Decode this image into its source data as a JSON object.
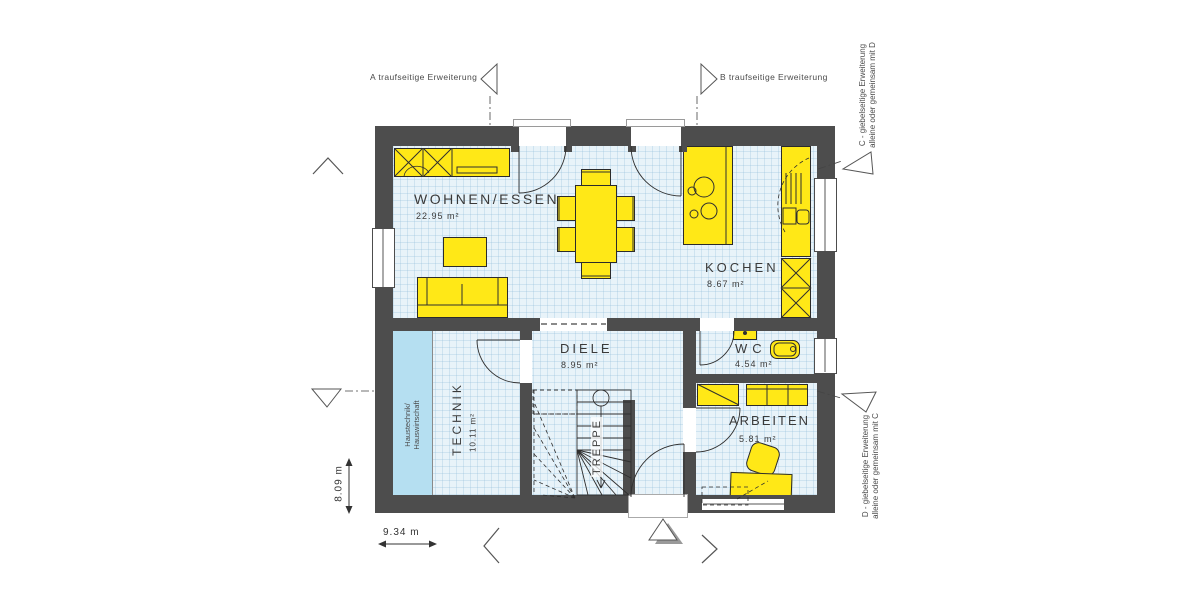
{
  "extension_markers": {
    "a": "A traufseitige Erweiterung",
    "b": "B traufseitige Erweiterung",
    "c_line1": "C - giebelseitige Erweiterung",
    "c_line2": "alleine oder gemeinsam mit D",
    "d_line1": "D - giebelseitige Erweiterung",
    "d_line2": "alleine oder gemeinsam mit C"
  },
  "rooms": {
    "wohnen_essen": {
      "name": "WOHNEN/ESSEN",
      "area": "22.95 m²"
    },
    "kochen": {
      "name": "KOCHEN",
      "area": "8.67 m²"
    },
    "diele": {
      "name": "DIELE",
      "area": "8.95 m²"
    },
    "technik": {
      "name": "TECHNIK",
      "area": "10.11 m²"
    },
    "wc": {
      "name": "WC",
      "area": "4.54 m²"
    },
    "arbeiten": {
      "name": "ARBEITEN",
      "area": "5.81 m²"
    },
    "treppe": {
      "name": "TREPPE"
    }
  },
  "annotations": {
    "technik_zone_line1": "Haustechnik/",
    "technik_zone_line2": "Hauswirtschaft"
  },
  "dimensions": {
    "depth": "8.09 m",
    "width": "9.34 m"
  },
  "colors": {
    "wall": "#4d4d4d",
    "furniture": "#ffe817",
    "floor": "#e8f3f9",
    "technik_zone": "#b5dff1",
    "line": "#2f2f2f",
    "text": "#3a3a3a"
  }
}
